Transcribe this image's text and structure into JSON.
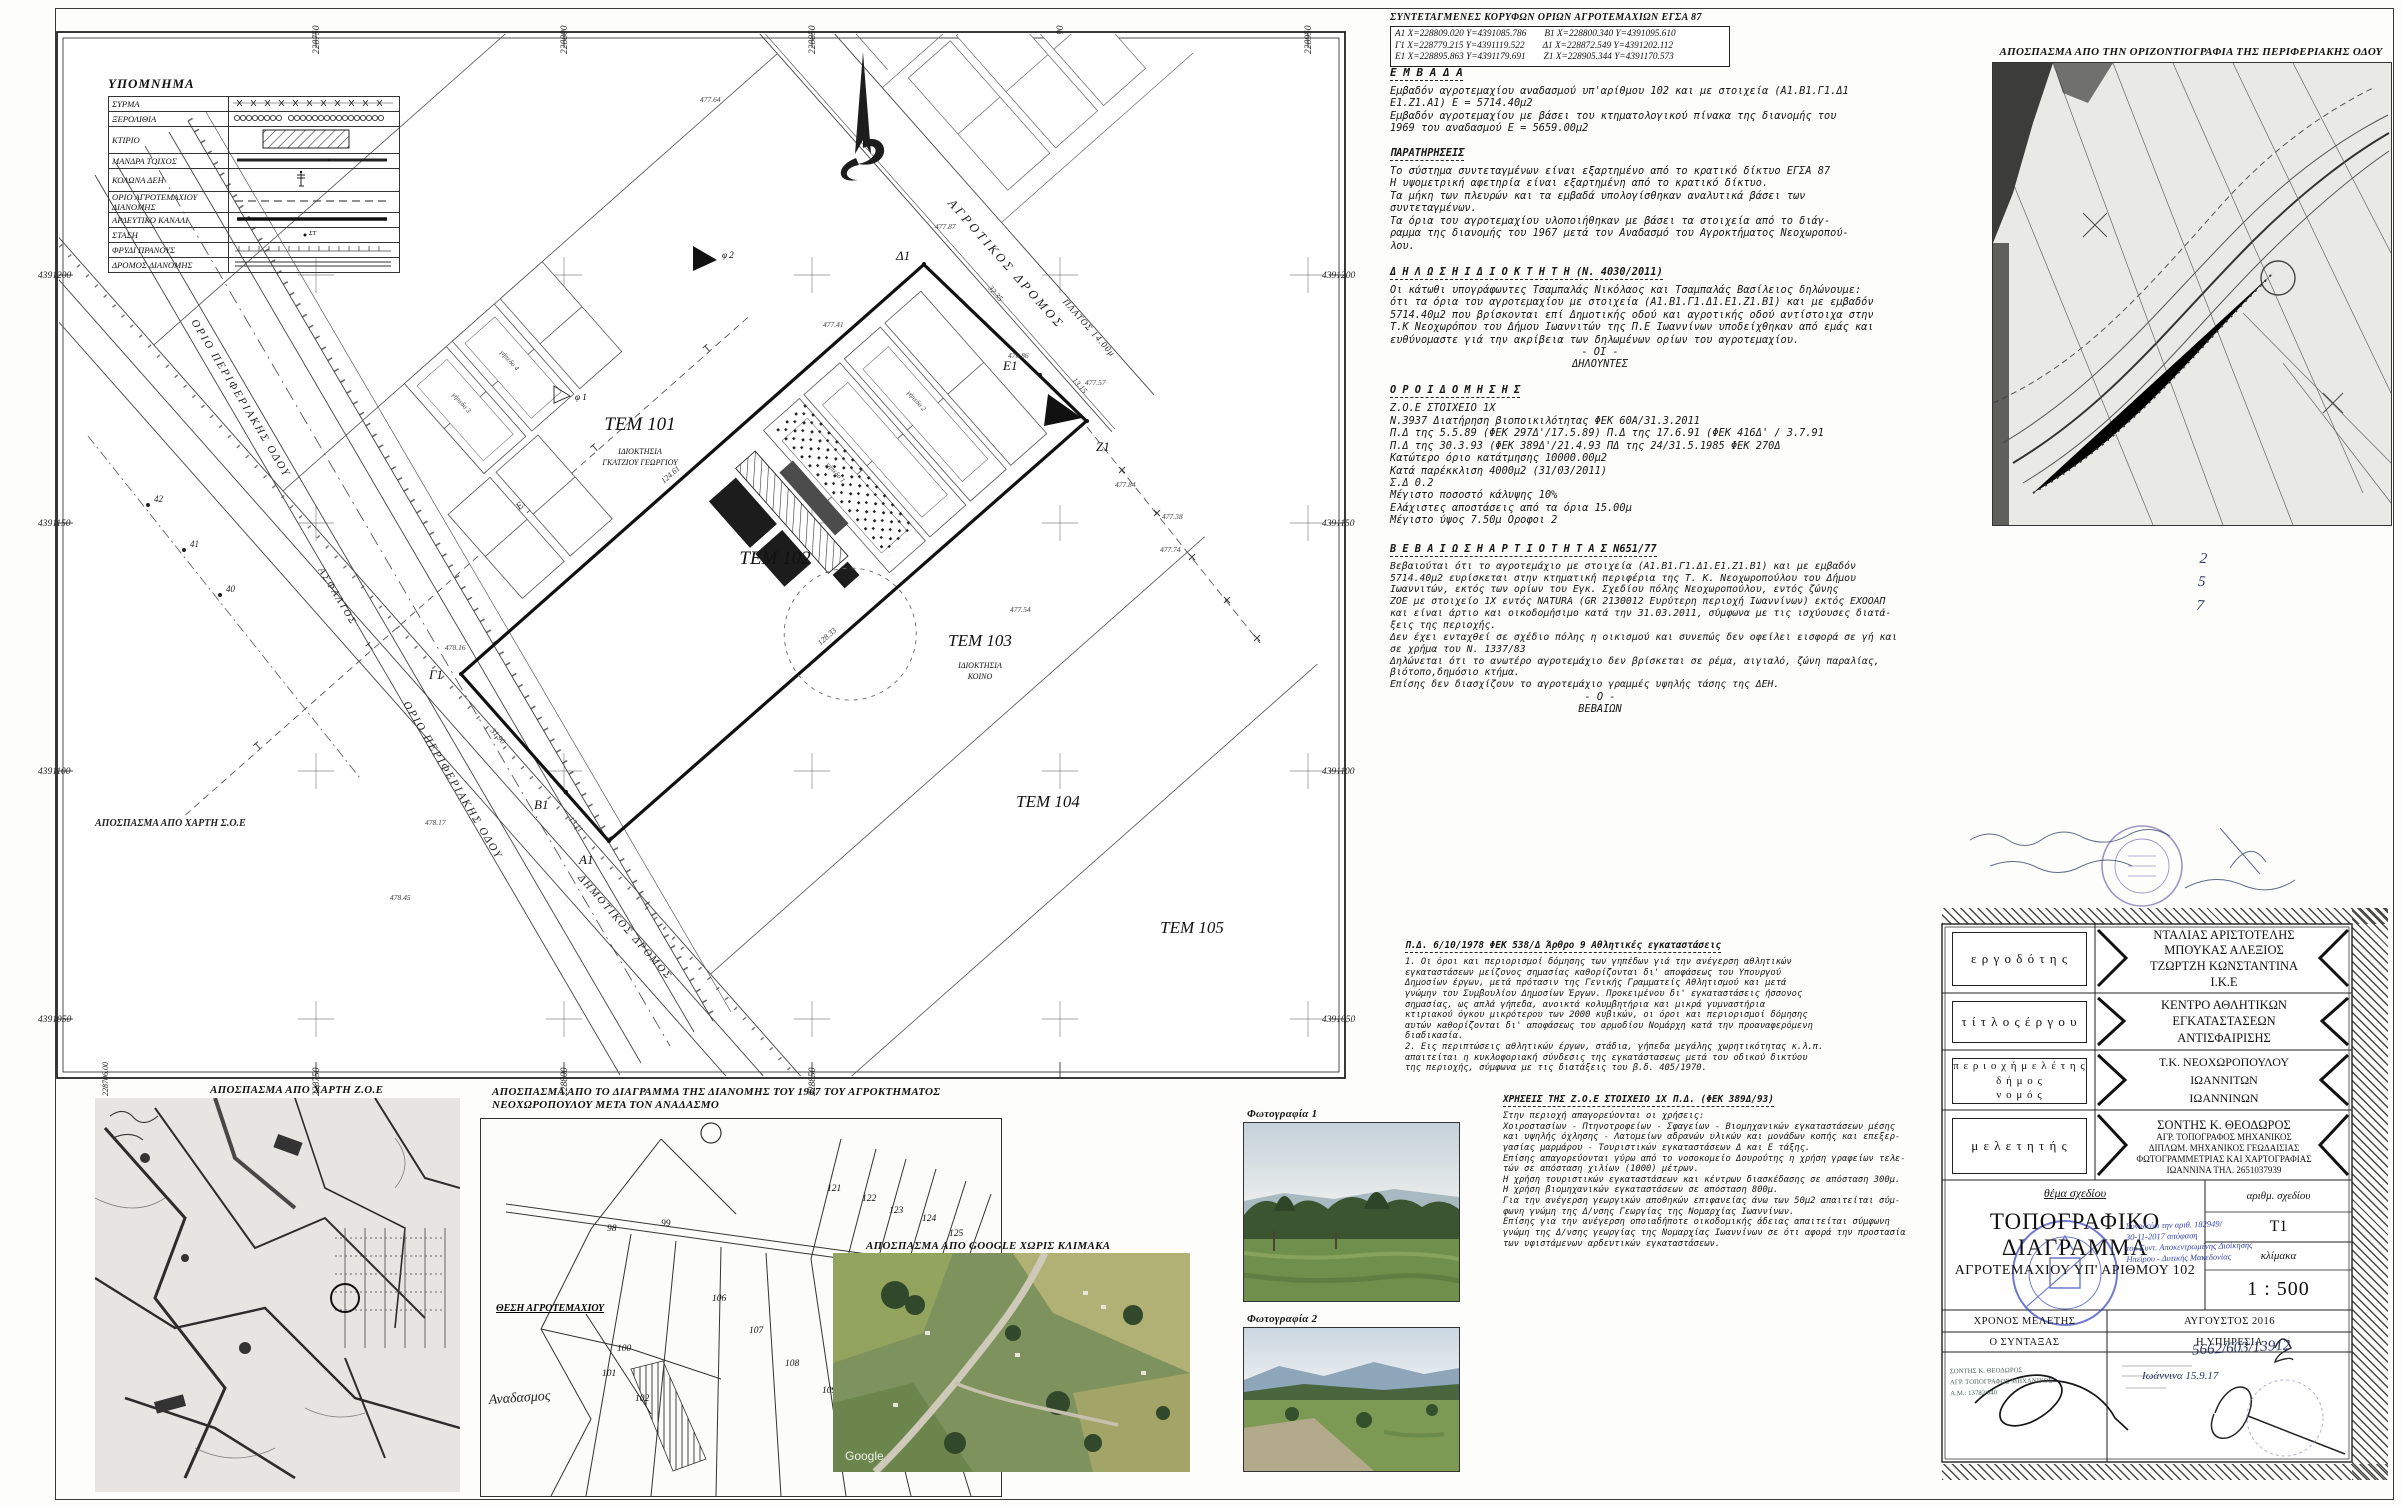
{
  "plan": {
    "grid_x": [
      "228750",
      "228800",
      "228850",
      "228900",
      "228950"
    ],
    "grid_x_bottom": [
      "228706.00",
      "228750",
      "228800",
      "228850"
    ],
    "grid_y": [
      "4391200",
      "4391150",
      "4391100",
      "4391050"
    ],
    "parcels": {
      "tem101": "ΤΕΜ 101",
      "tem101_owner1": "ΙΔΙΟΚΤΗΣΙΑ",
      "tem101_owner2": "ΓΚΑΤΖΙΟΥ ΓΕΩΡΓΙΟΥ",
      "tem102": "ΤΕΜ 102",
      "tem103": "ΤΕΜ 103",
      "tem103_owner1": "ΙΔΙΟΚΤΗΣΙΑ",
      "tem103_owner2": "ΚΟΙΝΟ",
      "tem104": "ΤΕΜ 104",
      "tem105": "ΤΕΜ 105"
    },
    "roads": {
      "agrotikos": "ΑΓΡΟΤΙΚΟΣ ΔΡΟΜΟΣ",
      "platos": "ΠΛΑΤΟΣ 14.00μ",
      "orio_perif": "ΟΡΙΟ ΠΕΡΙΦΕΡΙΑΚΗΣ ΟΔΟΥ",
      "asfaltos": "ΑΣΦΑΛΤΟΣ",
      "dimotikos": "ΔΗΜΟΤΙΚΟΣ ΔΡΟΜΟΣ",
      "diktyo_dei": "ΔΙΚΤΥΟ ΔΕΗ"
    },
    "vertices": [
      "Α1",
      "Β1",
      "Γ1",
      "Δ1",
      "Ε1",
      "Ζ1"
    ],
    "edge_lengths": [
      "124.61",
      "32.35",
      "13.15",
      "128.33",
      "31.90",
      "13.11"
    ],
    "spot_heights": [
      "477.87",
      "477.41",
      "476.86",
      "477.57",
      "477.84",
      "477.38",
      "477.54",
      "477.74",
      "477.64",
      "478.16",
      "478.17",
      "478.45"
    ],
    "point_marks": [
      "40",
      "41",
      "42"
    ],
    "photo_marks": [
      "φ 1",
      "φ 2"
    ],
    "court_labels": [
      "γήπεδο 1",
      "γήπεδο 2",
      "γήπεδο 3",
      "γήπεδο 4"
    ],
    "soe_label": "ΑΠΟΣΠΑΣΜΑ ΑΠΟ ΧΑΡΤΗ Σ.Ο.Ε"
  },
  "legend": {
    "title": "ΥΠΟΜΝΗΜΑ",
    "rows": [
      {
        "label": "ΣΥΡΜΑ"
      },
      {
        "label": "ΞΕΡΟΛΙΘΙΑ"
      },
      {
        "label": "ΚΤΙΡΙΟ"
      },
      {
        "label": "ΜΑΝΔΡΑ ΤΟΙΧΟΣ"
      },
      {
        "label": "ΚΟΛΩΝΑ ΔΕΗ"
      },
      {
        "label": "ΟΡΙΟ ΑΓΡΟΤΕΜΑΧΙΟΥ ΔΙΑΝΟΜΗΣ"
      },
      {
        "label": "ΑΡΔΕΥΤΙΚΟ ΚΑΝΑΛΙ"
      },
      {
        "label": "ΣΤΑΣΗ",
        "sym": "ΣΤ"
      },
      {
        "label": "ΦΡΥΔΙ ΠΡΑΝΟΥΣ"
      },
      {
        "label": "ΔΡΟΜΟΣ ΔΙΑΝΟΜΗΣ"
      }
    ]
  },
  "coords": {
    "title": "ΣΥΝΤΕΤΑΓΜΕΝΕΣ ΚΟΡΥΦΩΝ ΟΡΙΩΝ ΑΓΡΟΤΕΜΑΧΙΩΝ ΕΓΣΑ 87",
    "rows": [
      {
        "a": "Α1  Χ=228809.020  Υ=4391085.786",
        "b": "Β1  Χ=228800.340  Υ=4391095.610"
      },
      {
        "a": "Γ1  Χ=228779.215  Υ=4391119.522",
        "b": "Δ1  Χ=228872.549  Υ=4391202.112"
      },
      {
        "a": "Ε1  Χ=228895.863  Υ=4391179.691",
        "b": "Ζ1  Χ=228905.344  Υ=4391170.573"
      }
    ]
  },
  "sections": {
    "embada_title": "Ε Μ Β Α Δ Α",
    "embada_body": "Εμβαδόν αγροτεμαχίου αναδασμού υπ'αρίθμου 102 και με στοιχεία (Α1.Β1.Γ1.Δ1\nΕ1.Ζ1.Α1) Ε = 5714.40μ2\nΕμβαδόν αγροτεμαχίου με βάσει του κτηματολογικού πίνακα της διανομής του\n1969 του αναδασμού Ε = 5659.00μ2",
    "parat_title": "ΠΑΡΑΤΗΡΗΣΕΙΣ",
    "parat_body": "Το σύστημα συντεταγμένων είναι εξαρτημένο από το κρατικό δίκτυο ΕΓΣΑ 87\nΗ υψομετρική αφετηρία είναι εξαρτημένη από το κρατικό δίκτυο.\nΤα μήκη των πλευρών και τα εμβαδά υπολογίσθηκαν αναλυτικά βάσει των\nσυντεταγμένων.\nΤα όρια του αγροτεμαχίου υλοποιήθηκαν με βάσει τα στοιχεία από το διάγ-\nραμμα της διανομής του 1967 μετά τον Αναδασμό του Αγροκτήματος Νεοχωροπού-\nλου.",
    "dilosi_title": "Δ Η Λ Ω Σ Η    Ι Δ Ι Ο Κ Τ Η Τ Η (Ν. 4030/2011)",
    "dilosi_body": "Οι κάτωθι υπογράφωντες Τσαμπαλάς Νικόλαος και Τσαμπαλάς Βασίλειος δηλώνουμε:\nότι τα όρια του αγροτεμαχίου με στοιχεία (Α1.Β1.Γ1.Δ1.Ε1.Ζ1.Β1) και με εμβαδόν\n5714.40μ2 που βρίσκονται επί Δημοτικής οδού και αγροτικής οδού αντίστοιχα στην\nΤ.Κ Νεοχωρόπου του Δήμου Ιωαννιτών της Π.Ε Ιωαννίνων υποδείχθηκαν από εμάς και\nευθύνομαστε γιά την ακρίβεια των δηλωμένων ορίων του αγροτεμαχίου.",
    "dilosi_sig1": "- ΟΙ -",
    "dilosi_sig2": "ΔΗΛΟΥΝΤΕΣ",
    "oroi_title": "Ο Ρ Ο Ι    Δ Ο Μ Η Σ Η Σ",
    "oroi_body": "Ζ.Ο.Ε ΣΤΟΙΧΕΙΟ 1Χ\nΝ.3937 Διατήρηση βιοποικιλότητας ΦΕΚ 60Α/31.3.2011\nΠ.Δ της 5.5.89 (ΦΕΚ 297Δ'/17.5.89) Π.Δ της 17.6.91 (ΦΕΚ 416Δ' / 3.7.91\nΠ.Δ της 30.3.93 (ΦΕΚ 389Δ'/21.4.93 ΠΔ της 24/31.5.1985 ΦΕΚ 270Δ\nΚατώτερο όριο κατάτμησης 10000.00μ2\nΚατά παρέκκλιση 4000μ2 (31/03/2011)\nΣ.Δ 0.2\nΜέγιστο ποσοστό κάλυψης 10%\nΕλάχιστες αποστάσεις από τα όρια 15.00μ\nΜέγιστο ύψος 7.50μ Οροφοι 2",
    "vev_title": "Β Ε Β Α Ι Ω Σ Η   Α Ρ Τ Ι Ο Τ Η Τ Α Σ   Ν651/77",
    "vev_body": "Βεβαιούται ότι το αγροτεμάχιο με στοιχεία (Α1.Β1.Γ1.Δ1.Ε1.Ζ1.Β1) και με εμβαδόν\n5714.40μ2 ευρίσκεται στην κτηματική περιφέρια της Τ. Κ. Νεοχωροπούλου του Δήμου\nΙωαννιτών, εκτός των ορίων του Εγκ. Σχεδίου πόλης Νεοχωροπούλου, εντός ζώνης\nΖΟΕ με στοιχείο 1Χ εντός NATURA (GR 2130012 Ευρύτερη περιοχή Ιωαννίνων) εκτός ΕΧΟΟΑΠ\nκαι είναι άρτιο και οικοδομήσιμο κατά την 31.03.2011, σύμφωνα με τις ισχύουσες διατά-\nξεις της περιοχής.\nΔεν έχει ενταχθεί σε σχέδιο πόλης η οικισμού και συνεπώς δεν οφείλει εισφορά σε γή και\nσε χρήμα του Ν. 1337/83\nΔηλώνεται ότι το ανωτέρο αγροτεμάχιο δεν βρίσκεται σε ρέμα, αιγιαλό, ζώνη παραλίας,\nβιότοπο,δημόσιο κτήμα.\nΕπίσης δεν διασχίζουν το αγροτεμάχιο γραμμές υψηλής τάσης της ΔΕΗ.",
    "vev_sig1": "- Ο -",
    "vev_sig2": "ΒΕΒΑΙΩΝ",
    "pd_title": "Π.Δ. 6/10/1978 ΦΕΚ 538/Δ Άρθρο 9 Αθλητικές εγκαταστάσεις",
    "pd_body": "1. Οι όροι και περιορισμοί δόμησης των γηπέδων γιά την ανέγερση αθλητικών\nεγκαταστάσεων μείζονος σημασίας καθορίζονται δι' αποφάσεως του Υπουργού\nΔημοσίων έργων, μετά πρότασιν της Γενικής Γραμματείς Αθλητισμού και μετά\nγνώμην του Συμβουλίου Δημοσίων Έργων. Προκειμένου δι' εγκαταστάσεις ήσσονος\nσημασίας, ως απλά γήπεδα, ανοικτά κολυμβητήρια και μικρά γυμναστήρια\nκτιριακού όγκου μικρότερου των 2000 κυβικών, οι όροι και περιορισμοί δόμησης\nαυτών καθορίζονται δι' αποφάσεως του αρμοδίου Νομάρχη κατά την προαναφερόμενη\nδιαδικασία.\n2. Εις περιπτώσεις αθλητικών έργων, στάδια, γήπεδα μεγάλης χωρητικότητας κ.λ.π.\nαπαιτείται η κυκλοφοριακή σύνδεσις της εγκατάστασεως μετά του οδικού δικτύου\nτης περιοχής, σύμφωνα με τις διατάξεις του β.δ. 405/1970.",
    "xriseis_title": "ΧΡΗΣΕΙΣ ΤΗΣ Ζ.Ο.Ε ΣΤΟΙΧΕΙΟ 1Χ Π.Δ. (ΦΕΚ 389Δ/93)",
    "xriseis_body": "Στην περιοχή απαγορεύονται οι χρήσεις:\nΧοιροστασίων - Πτηνοτροφείων - Σφαγείων - Βιομηχανικών εγκαταστάσεων μέσης\nκαι υψηλής όχλησης - Λατομείων αδρανών υλικών και μονάδων κοπής και επεξερ-\nγασίας μαρμάρου - Τουριστικών εγκαταστάσεων Δ και Ε τάξης.\nΕπίσης απαγορεύονται γύρω από το νοσοκομείο Δουρούτης η χρήση γραφείων τελε-\nτών σε απόσταση χιλίων (1000) μέτρων.\nΗ χρήση τουριστικών εγκαταστάσεων και κέντρων διασκέδασης σε απόσταση 300μ.\nΗ χρήση βιομηχανικών εγκαταστάσεων σε απόσταση 800μ.\nΓια την ανέγερση γεωργικών αποθηκών επιφανείας άνω των 50μ2 απαιτείται σύμ-\nφωνη γνώμη της Δ/νσης Γεωργίας της Νομαρχίας Ιωαννίνων.\nΕπίσης για την ανέγερση οποιαδήποτε οικοδομικής άδειας απαιτείται σύμφωνη\nγνώμη της Δ/νσης γεωργίας της Νομαρχίας Ιωαννίνων σε ότι αφορά την προστασία\nτων υφιστάμενων αρδευτικών εγκαταστάσεων."
  },
  "excerpts": {
    "ortho": "ΑΠΟΣΠΑΣΜΑ ΑΠΟ ΤΗΝ ΟΡΙΖΟΝΤΙΟΓΡΑΦΙΑ ΤΗΣ ΠΕΡΙΦΕΡΙΑΚΗΣ ΟΔΟΥ",
    "zoe": "ΑΠΟΣΠΑΣΜΑ ΑΠΟ ΧΑΡΤΗ Ζ.Ο.Ε",
    "dianomi_1": "ΑΠΟΣΠΑΣΜΑ ΑΠΟ ΤΟ ΔΙΑΓΡΑΜΜΑ ΤΗΣ ΔΙΑΝΟΜΗΣ ΤΟΥ 1967 ΤΟΥ ΑΓΡΟΚΤΗΜΑΤΟΣ",
    "dianomi_2": "ΝΕΟΧΩΡΟΠΟΥΛΟΥ ΜΕΤΑ ΤΟΝ ΑΝΑΔΑΣΜΟ",
    "google": "ΑΠΟΣΠΑΣΜΑ ΑΠΟ GOOGLE ΧΩΡΙΣ ΚΛΙΜΑΚΑ",
    "google_mark": "Google",
    "photo1": "Φωτογραφία 1",
    "photo2": "Φωτογραφία 2",
    "thesi": "ΘΕΣΗ ΑΓΡΟΤΕΜΑΧΙΟΥ",
    "anadasmos": "Αναδασμος",
    "dianomi_numbers": [
      "98",
      "99",
      "100",
      "101",
      "102",
      "106",
      "107",
      "108",
      "109",
      "110",
      "121",
      "122",
      "123",
      "124",
      "125"
    ]
  },
  "titleblock": {
    "ergodotis_label": "ε ρ γ ο δ ό τ η ς",
    "ergodotis": "ΝΤΑΛΙΑΣ ΑΡΙΣΤΟΤΕΛΗΣ\nΜΠΟΥΚΑΣ ΑΛΕΞΙΟΣ\nΤΖΩΡΤΖΗ ΚΩΝΣΤΑΝΤΙΝΑ\nΙ.Κ.Ε",
    "titlos_label": "τ ί τ λ ο ς  έ ρ γ ο υ",
    "titlos": "ΚΕΝΤΡΟ ΑΘΛΗΤΙΚΩΝ\nΕΓΚΑΤΑΣΤΑΣΕΩΝ ΑΝΤΙΣΦΑΙΡΙΣΗΣ",
    "periohi_label": "π ε ρ ι ο χ ή  μ ε λ έ τ η ς\nδ ή μ ο ς\nν ο μ ό ς",
    "periohi": "Τ.Κ. ΝΕΟΧΩΡΟΠΟΥΛΟΥ\nΙΩΑΝΝΙΤΩΝ\nΙΩΑΝΝΙΝΩΝ",
    "meletitis_label": "μ ε λ ε τ η τ ή ς",
    "meletitis_name": "ΣΟΝΤΗΣ Κ. ΘΕΟΔΩΡΟΣ",
    "meletitis_rest": "ΑΓΡ. ΤΟΠΟΓΡΑΦΟΣ ΜΗΧΑΝΙΚΟΣ\nΔΙΠΛΩΜ. ΜΗΧΑΝΙΚΟΣ ΓΕΩΔΑΙΣΙΑΣ\nΦΩΤΟΓΡΑΜΜΕΤΡΙΑΣ ΚΑΙ ΧΑΡΤΟΓΡΑΦΙΑΣ\nΙΩΑΝΝΙΝΑ ΤΗΛ. 2651037939",
    "thema_label": "θέμα σχεδίου",
    "thema1": "ΤΟΠΟΓΡΑΦΙΚΟ ΔΙΑΓΡΑΜΜΑ",
    "thema2": "ΑΓΡΟΤΕΜΑΧΙΟΥ ΥΠ' ΑΡΙΘΜΟΥ 102",
    "arithm_label": "αριθμ. σχεδίου",
    "arithm": "Τ1",
    "klimaka_label": "κλίμακα",
    "klimaka": "1 : 500",
    "xronos_label": "ΧΡΟΝΟΣ ΜΕΛΕΤΗΣ",
    "xronos": "ΑΥΓΟΥΣΤΟΣ 2016",
    "syntaxas": "Ο ΣΥΝΤΑΞΑΣ",
    "ypiresia": "Η ΥΠΗΡΕΣΙΑ",
    "stamp_note": "Συνοδεύει την αριθ. 182949/\n30-11-2017 απόφαση\nτου Συντ. Αποκεντρωμένης Διοίκησης\nΗπείρου - Δυτικής Μακεδονίας",
    "hand_number": "5662/603/13912",
    "hand_date": "Ιωάννινα   15.9.17",
    "hand_col": "2\n5\n7",
    "eng_stamp": "ΣΟΝΤΗΣ Κ. ΘΕΟΔΩΡΟΣ\nΑΓΡ. ΤΟΠΟΓΡΑΦΟΣ ΜΗΧΑΝΙΚΟΣ\nΑ.Μ.: 13782/040"
  }
}
